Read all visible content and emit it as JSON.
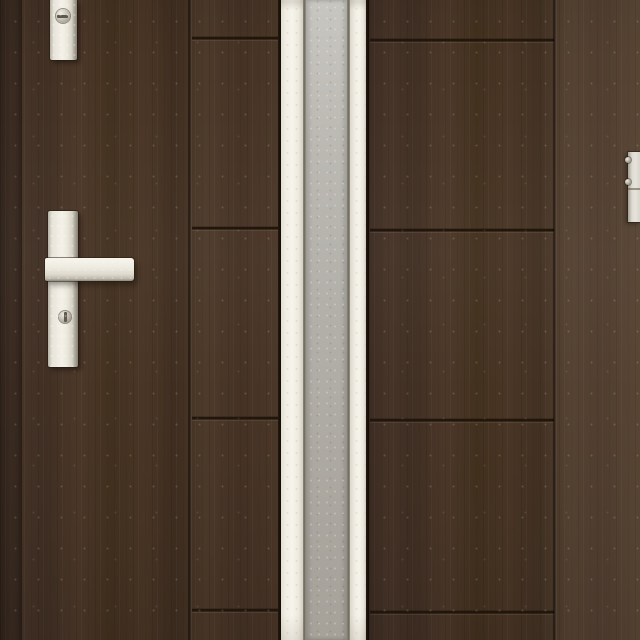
{
  "image": {
    "type": "product-photo",
    "subject": "Exterior entry door in dark walnut wood-grain finish with a central vertical frosted-glass strip, pearl-silver lever handle set and frame strike plate"
  },
  "scene": {
    "left_door_leaf": {
      "name": "left door leaf",
      "finish": "dark walnut woodgrain",
      "horizontal_groove_count": 4,
      "vertical_groove_count": 1
    },
    "glazing_strip": {
      "name": "vertical glazing strip",
      "frame_finish": "pearl white metal",
      "glass_finish": "frosted gray"
    },
    "right_door_leaf": {
      "name": "right door leaf",
      "finish": "dark walnut woodgrain",
      "horizontal_groove_count": 4,
      "vertical_groove_count": 1
    },
    "hardware": {
      "top_lock": "auxiliary lock escutcheon with cylinder face",
      "handle": "lever handle on long backplate with thumbturn",
      "strike_plate": "frame strike plate with two screws",
      "screw_count": 2
    }
  },
  "palette": {
    "wood_base": "#453225",
    "wood_dark": "#3b2b21",
    "wood_light": "#4d3a2a",
    "groove": "#221509",
    "metal_highlight": "#f4f1e9",
    "metal_shadow": "#878277",
    "frame_bar": "#f0ede3",
    "glass_top": "#c8c6c0",
    "glass_bottom": "#a6a29a",
    "seam": "#6e695c"
  }
}
